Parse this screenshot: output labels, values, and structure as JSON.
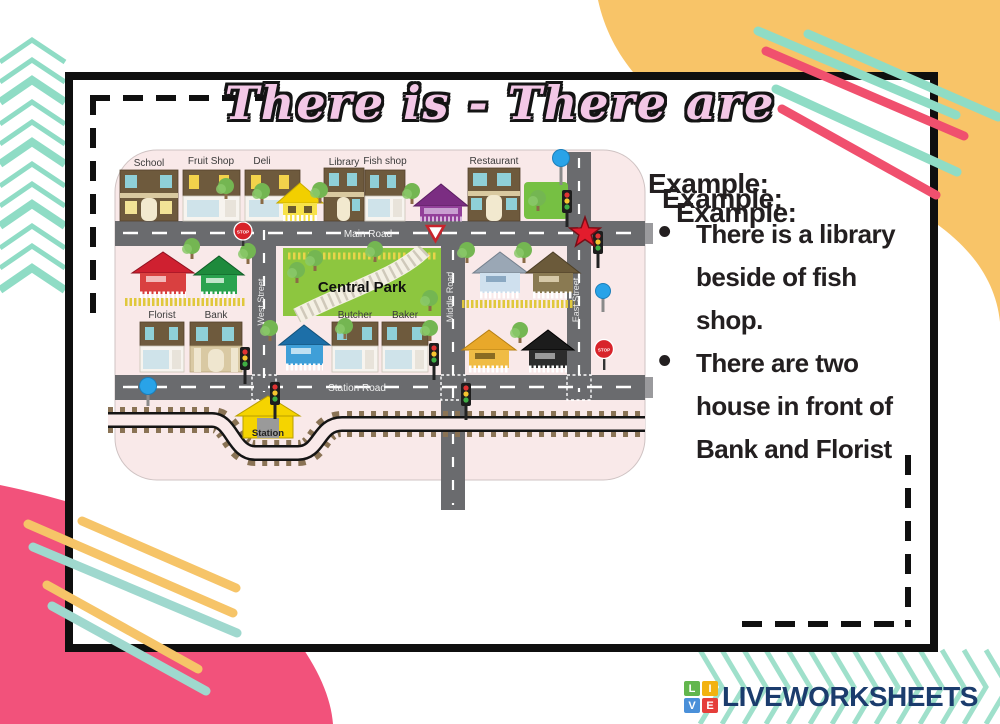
{
  "title": "There is - There are",
  "examples": {
    "heading": "Example:",
    "bullets": [
      "There is a library\nbeside of fish\nshop.",
      "There are two\nhouse in front of\nBank and Florist"
    ]
  },
  "map": {
    "places": {
      "school": "School",
      "fruit_shop": "Fruit Shop",
      "deli": "Deli",
      "library": "Library",
      "fish_shop": "Fish shop",
      "restaurant": "Restaurant",
      "central_park": "Central Park",
      "florist": "Florist",
      "bank": "Bank",
      "butcher": "Butcher",
      "baker": "Baker",
      "station": "Station"
    },
    "roads": {
      "main": "Main Road",
      "station": "Station Road",
      "west": "West Street",
      "middle": "Middle Road",
      "east": "East Street"
    },
    "signs": {
      "stop": "STOP"
    }
  },
  "footer": {
    "brand": "LIVEWORKSHEETS",
    "logo_letters": {
      "l": "L",
      "i": "I",
      "v": "V",
      "e": "E"
    }
  },
  "colors": {
    "pink_blob": "#f2527b",
    "yellow_blob": "#f8c468",
    "mint": "#8fdcc5",
    "red_line": "#f0506e",
    "title_pink": "#f3c7e6",
    "brand_navy": "#1b3c6d",
    "map_background": "#f9e9e9",
    "road_gray": "#6a6b6e",
    "park_green": "#8dc63f"
  }
}
